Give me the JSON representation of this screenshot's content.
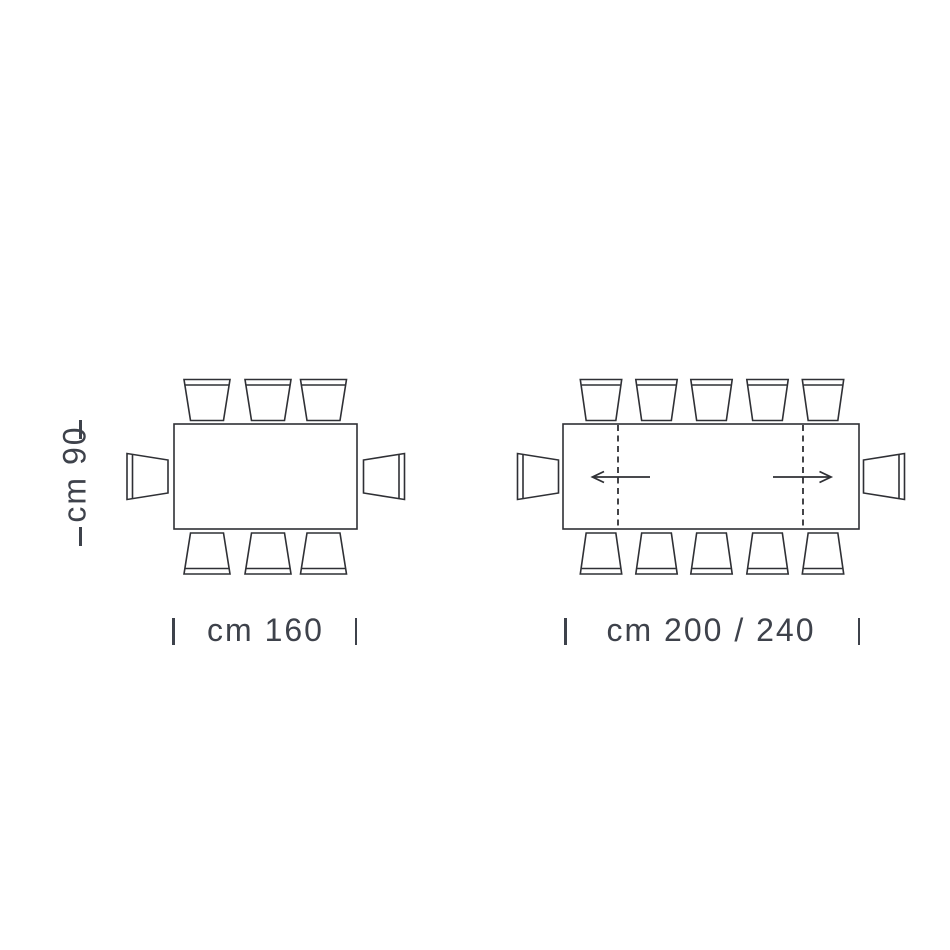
{
  "canvas": {
    "background_color": "#ffffff",
    "line_color": "#2f3035",
    "text_color": "#3e424b"
  },
  "left_table": {
    "width_label": "cm 160",
    "depth_label": "cm 90",
    "chairs_top": 3,
    "chairs_bottom": 3,
    "chairs_left": 1,
    "chairs_right": 1,
    "total_seats": 8,
    "extendable": false
  },
  "right_table": {
    "width_label": "cm 200 / 240",
    "chairs_top": 5,
    "chairs_bottom": 5,
    "chairs_left": 1,
    "chairs_right": 1,
    "total_seats": 12,
    "extendable": true,
    "extension_leaf_lines": 2,
    "extension_arrows": 2
  }
}
